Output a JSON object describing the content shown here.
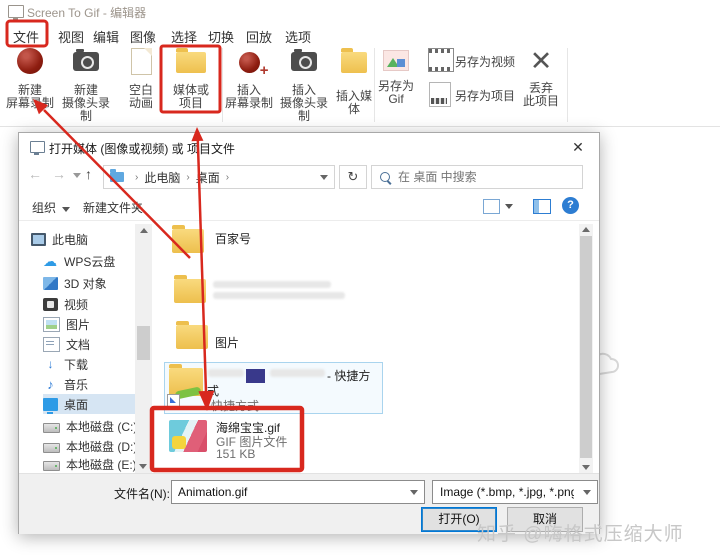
{
  "window": {
    "title": "Screen To Gif - 编辑器"
  },
  "menu": {
    "items": [
      "文件",
      "视图",
      "编辑",
      "图像",
      "选择",
      "切换",
      "回放",
      "选项"
    ]
  },
  "ribbon": {
    "groups": [
      "新建",
      "插入",
      "文件"
    ],
    "new_recording": {
      "l1": "新建",
      "l2": "屏幕录制"
    },
    "new_webcam": {
      "l1": "新建",
      "l2": "摄像头录制"
    },
    "blank_animation": {
      "l1": "空白",
      "l2": "动画"
    },
    "media_project": {
      "l1": "媒体或",
      "l2": "项目"
    },
    "insert_recording": {
      "l1": "插入",
      "l2": "屏幕录制"
    },
    "insert_webcam": {
      "l1": "插入",
      "l2": "摄像头录制"
    },
    "insert_media": {
      "label": "插入媒体"
    },
    "save_gif": {
      "l1": "另存为",
      "l2": "Gif"
    },
    "save_video": {
      "label": "另存为视频"
    },
    "save_project": {
      "label": "另存为项目"
    },
    "discard": {
      "l1": "丢弃",
      "l2": "此项目"
    }
  },
  "dialog": {
    "title": "打开媒体 (图像或视频) 或 项目文件",
    "breadcrumb": {
      "root": "此电脑",
      "current": "桌面",
      "sep": "›"
    },
    "search_placeholder": "在 桌面 中搜索",
    "toolbar": {
      "organize": "组织",
      "new_folder": "新建文件夹"
    },
    "sidebar": {
      "items": [
        "此电脑",
        "WPS云盘",
        "3D 对象",
        "视频",
        "图片",
        "文档",
        "下载",
        "音乐",
        "桌面",
        "本地磁盘 (C:)",
        "本地磁盘 (D:)",
        "本地磁盘 (E:)"
      ]
    },
    "files": {
      "folder1": "百家号",
      "folder3": "图片",
      "shortcut": {
        "line1_suffix": "- 快捷方",
        "line2": "式",
        "meta": "快捷方式"
      },
      "gif": {
        "name": "海绵宝宝.gif",
        "type": "GIF 图片文件",
        "size": "151 KB"
      }
    },
    "footer": {
      "filename_label": "文件名(N):",
      "filename_value": "Animation.gif",
      "filetype_value": "Image (*.bmp, *.jpg, *.png, *",
      "open": "打开(O)",
      "cancel": "取消"
    }
  },
  "icons": {
    "close": "✕",
    "back": "←",
    "forward": "→",
    "up": "↑",
    "refresh": "↻",
    "help": "?",
    "down_arrow": "↓",
    "music_note": "♪"
  },
  "watermark": "知乎 @嗨格式压缩大师",
  "colors": {
    "annotation_red": "#d8281e",
    "accent_blue": "#0078d7",
    "selection_border": "#a9d4ee"
  }
}
